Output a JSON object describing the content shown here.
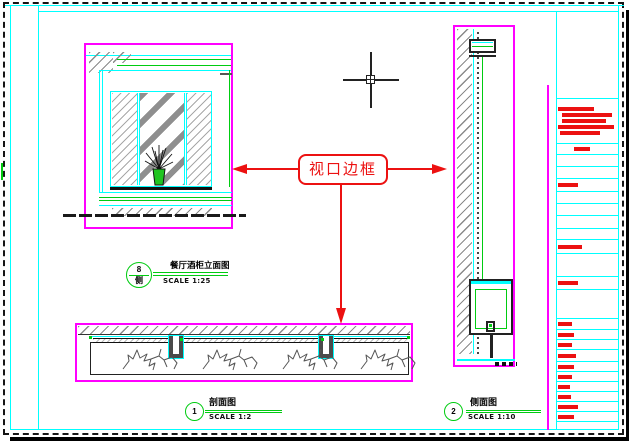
{
  "drawing": {
    "callout": {
      "label": "视口边框"
    },
    "labels": {
      "elevation": {
        "bubble_top": "8",
        "bubble_bottom": "侧",
        "title": "餐厅酒柜立面图",
        "scale": "SCALE 1:25"
      },
      "section_horizontal": {
        "bubble": "1",
        "title": "剖面图",
        "scale": "SCALE 1:2"
      },
      "section_vertical": {
        "bubble": "2",
        "title": "侧面图",
        "scale": "SCALE 1:10"
      }
    },
    "colors": {
      "viewport_border": "#ff00ff",
      "frame": "#00ffff",
      "annotation_red": "#ec1111",
      "symbol_green": "#00cc11",
      "hatch_gray": "#8a8a8a"
    },
    "titleblock": {
      "description": "title block column with red text lines (illegible at this zoom)",
      "rows": [
        {
          "h": 88,
          "bars": []
        },
        {
          "h": 45,
          "bars": [
            [
              2,
              36
            ],
            [
              6,
              50
            ],
            [
              6,
              44
            ],
            [
              2,
              56
            ],
            [
              4,
              40
            ]
          ]
        },
        {
          "h": 11,
          "bars": [
            [
              18,
              16
            ]
          ]
        },
        {
          "h": 12,
          "bars": []
        },
        {
          "h": 12,
          "bars": []
        },
        {
          "h": 13,
          "bars": [
            [
              2,
              20
            ]
          ]
        },
        {
          "h": 12,
          "bars": []
        },
        {
          "h": 12,
          "bars": []
        },
        {
          "h": 13,
          "bars": []
        },
        {
          "h": 11,
          "bars": []
        },
        {
          "h": 14,
          "bars": [
            [
              2,
              24
            ]
          ]
        },
        {
          "h": 23,
          "bars": []
        },
        {
          "h": 13,
          "bars": [
            [
              2,
              20
            ]
          ]
        },
        {
          "h": 29,
          "bars": []
        },
        {
          "h": 11,
          "bars": [
            [
              2,
              14
            ]
          ]
        },
        {
          "h": 10,
          "bars": [
            [
              2,
              16
            ]
          ]
        },
        {
          "h": 10,
          "bars": [
            [
              2,
              14
            ]
          ]
        },
        {
          "h": 12,
          "bars": [
            [
              2,
              18
            ]
          ]
        },
        {
          "h": 10,
          "bars": [
            [
              2,
              16
            ]
          ]
        },
        {
          "h": 10,
          "bars": [
            [
              2,
              14
            ]
          ]
        },
        {
          "h": 10,
          "bars": [
            [
              2,
              12
            ]
          ]
        },
        {
          "h": 10,
          "bars": [
            [
              2,
              13
            ]
          ]
        },
        {
          "h": 10,
          "bars": [
            [
              2,
              20
            ]
          ]
        },
        {
          "h": 10,
          "bars": [
            [
              2,
              16
            ]
          ]
        },
        {
          "h": 8,
          "bars": []
        }
      ]
    },
    "wood_grain_count": 4
  }
}
